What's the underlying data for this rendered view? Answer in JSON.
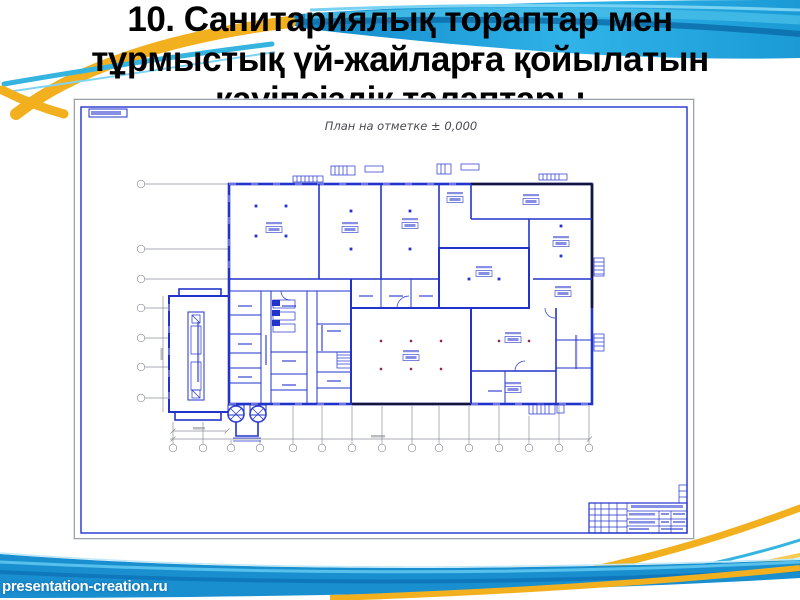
{
  "slide": {
    "title_lines": [
      "10. Санитариялық тораптар мен",
      "тұрмыстық үй-жайларға қойылатын",
      "қауіпсіздік талаптары"
    ]
  },
  "drawing": {
    "plan_title": "План на отметке ± 0,000"
  },
  "footer": {
    "watermark": "presentation-creation.ru"
  },
  "colors": {
    "swoosh_blue": "#2aaee6",
    "swoosh_dark_blue": "#0d79bd",
    "swoosh_cyan": "#35b4e0",
    "swoosh_yellow": "#f2b01e",
    "plan_line_blue": "#2233cc",
    "plan_wall_dark": "#14143c",
    "stair_circle_fill": "#f5c04a",
    "title_text": "#000000",
    "watermark_text": "#ffffff"
  }
}
